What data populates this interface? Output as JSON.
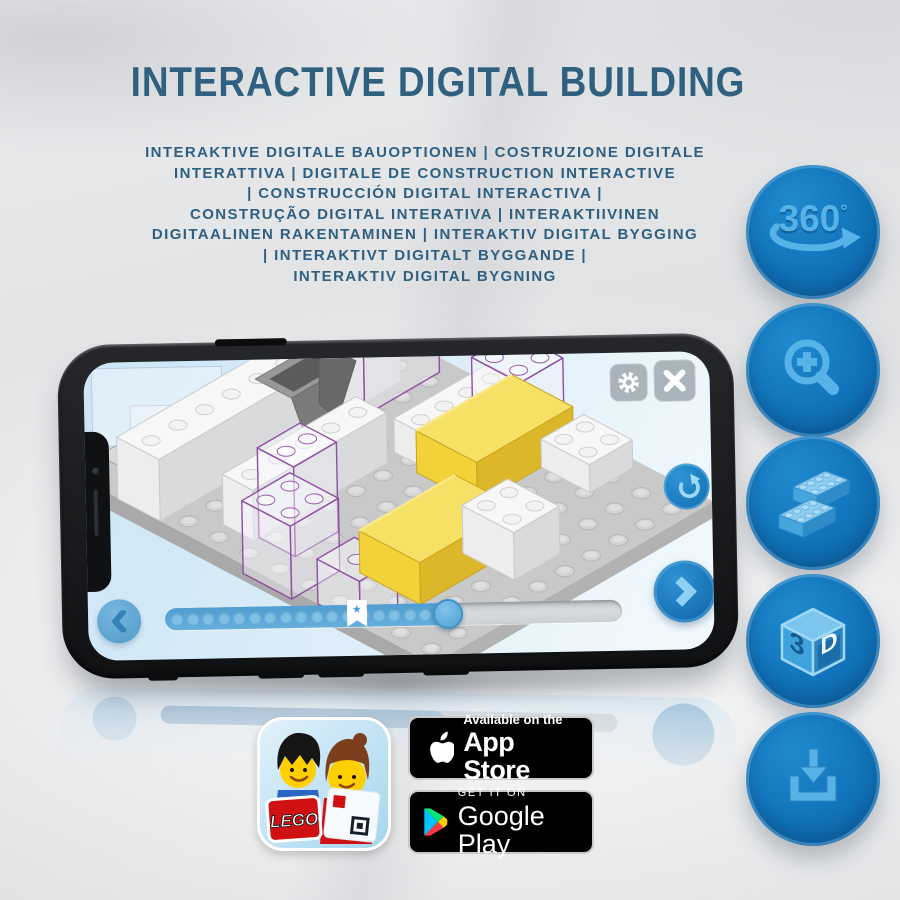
{
  "title": "INTERACTIVE DIGITAL BUILDING",
  "subtitle": {
    "lines": [
      "INTERAKTIVE DIGITALE BAUOPTIONEN | COSTRUZIONE DIGITALE",
      "INTERATTIVA | DIGITALE DE CONSTRUCTION INTERACTIVE",
      "| CONSTRUCCIÓN DIGITAL INTERACTIVA |",
      "CONSTRUÇÃO DIGITAL INTERATIVA | INTERAKTIIVINEN",
      "DIGITAALINEN RAKENTAMINEN | INTERAKTIV DIGITAL BYGGING",
      "| INTERAKTIVT DIGITALT BYGGANDE |",
      "INTERAKTIV DIGITAL BYGNING"
    ]
  },
  "features": {
    "rotate360": {
      "label": "360",
      "degree": "°",
      "icon": "360-rotate-icon"
    },
    "zoom": {
      "icon": "magnifier-plus-icon"
    },
    "bricks": {
      "icon": "lego-bricks-icon"
    },
    "threeD": {
      "label_3": "3",
      "label_d": "D",
      "icon": "3d-cube-icon"
    },
    "download": {
      "icon": "download-icon"
    }
  },
  "phone": {
    "slider": {
      "progress_percent": 62,
      "bookmark_percent": 42,
      "star": "★"
    }
  },
  "badges": {
    "app_store": {
      "line1": "Available on the",
      "line2": "App Store"
    },
    "google_play": {
      "line1": "GET IT ON",
      "line2": "Google Play"
    },
    "lego_icon": {
      "logo_text": "LEGO"
    }
  },
  "colors": {
    "title_blue": "#30607f",
    "button_blue": "#1174ba",
    "icon_light_blue": "#56b3e8",
    "screen_blue": "#d8ebf7",
    "brick_yellow": "#f2d139",
    "ghost_outline_purple": "#8d4fa0"
  }
}
